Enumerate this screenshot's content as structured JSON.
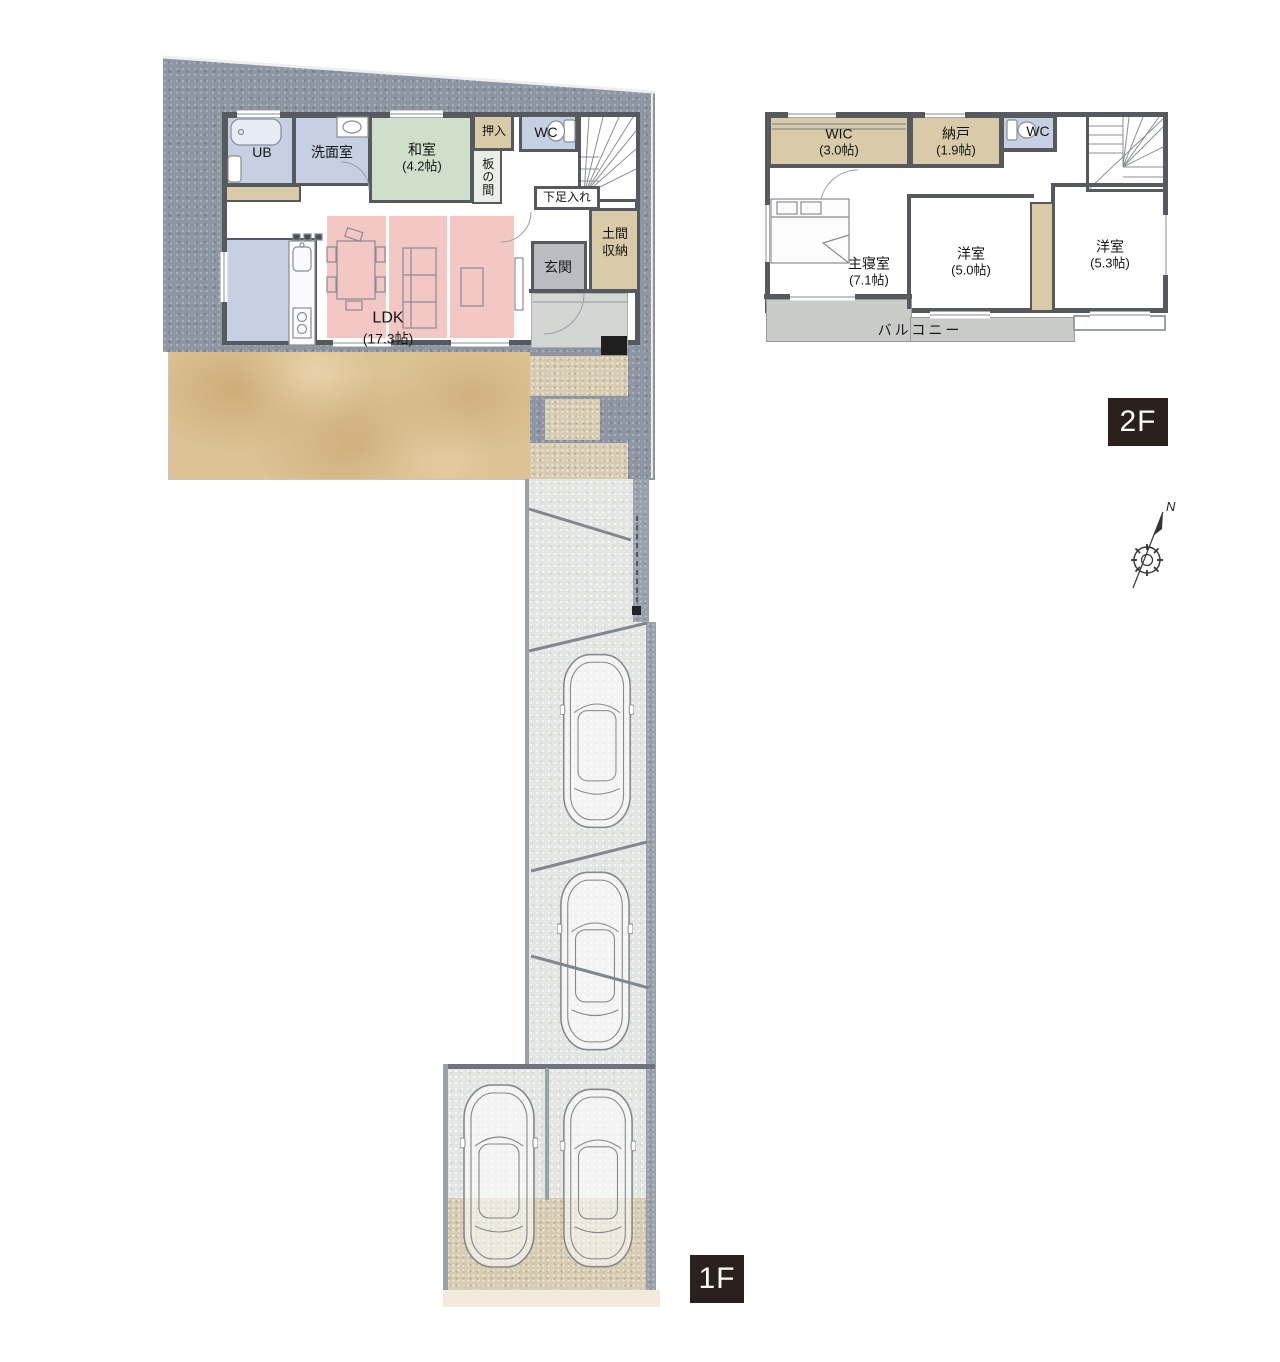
{
  "plan": {
    "floor1": {
      "badge": "1F",
      "rooms": {
        "ub": {
          "name": "UB"
        },
        "senmenshitsu": {
          "name": "洗面室"
        },
        "washitsu": {
          "name": "和室",
          "size": "(4.2帖)"
        },
        "oshiire": {
          "name": "押入"
        },
        "wc": {
          "name": "WC"
        },
        "itanoma": {
          "name": "板の間"
        },
        "shitasokuire": {
          "name": "下足入れ"
        },
        "domashuno": {
          "name": "土間収納"
        },
        "genkan": {
          "name": "玄関"
        },
        "ldk": {
          "name": "LDK",
          "size": "(17.3帖)"
        }
      }
    },
    "floor2": {
      "badge": "2F",
      "rooms": {
        "wic": {
          "name": "WIC",
          "size": "(3.0帖)"
        },
        "nando": {
          "name": "納戸",
          "size": "(1.9帖)"
        },
        "wc": {
          "name": "WC"
        },
        "shinshitsu": {
          "name": "主寝室",
          "size": "(7.1帖)"
        },
        "yoshitsu_a": {
          "name": "洋室",
          "size": "(5.0帖)"
        },
        "yoshitsu_b": {
          "name": "洋室",
          "size": "(5.3帖)"
        },
        "balcony": {
          "name": "バルコニー"
        }
      }
    },
    "compass": {
      "north": "N"
    },
    "colors": {
      "badge_bg": "#2b211c",
      "wall": "#565a5e",
      "site_gray": "#8e95a3",
      "water_blue": "#c6d0e2",
      "tatami_green": "#cfdfc9",
      "storage_tan": "#d9cba8",
      "rug_pink": "#f3c8c4",
      "genkan_gray": "#b9bcc0",
      "garden_sand": "#dcc294",
      "balcony_gray": "#c9cbc9",
      "driveway_gray": "#e4e6e4"
    }
  }
}
